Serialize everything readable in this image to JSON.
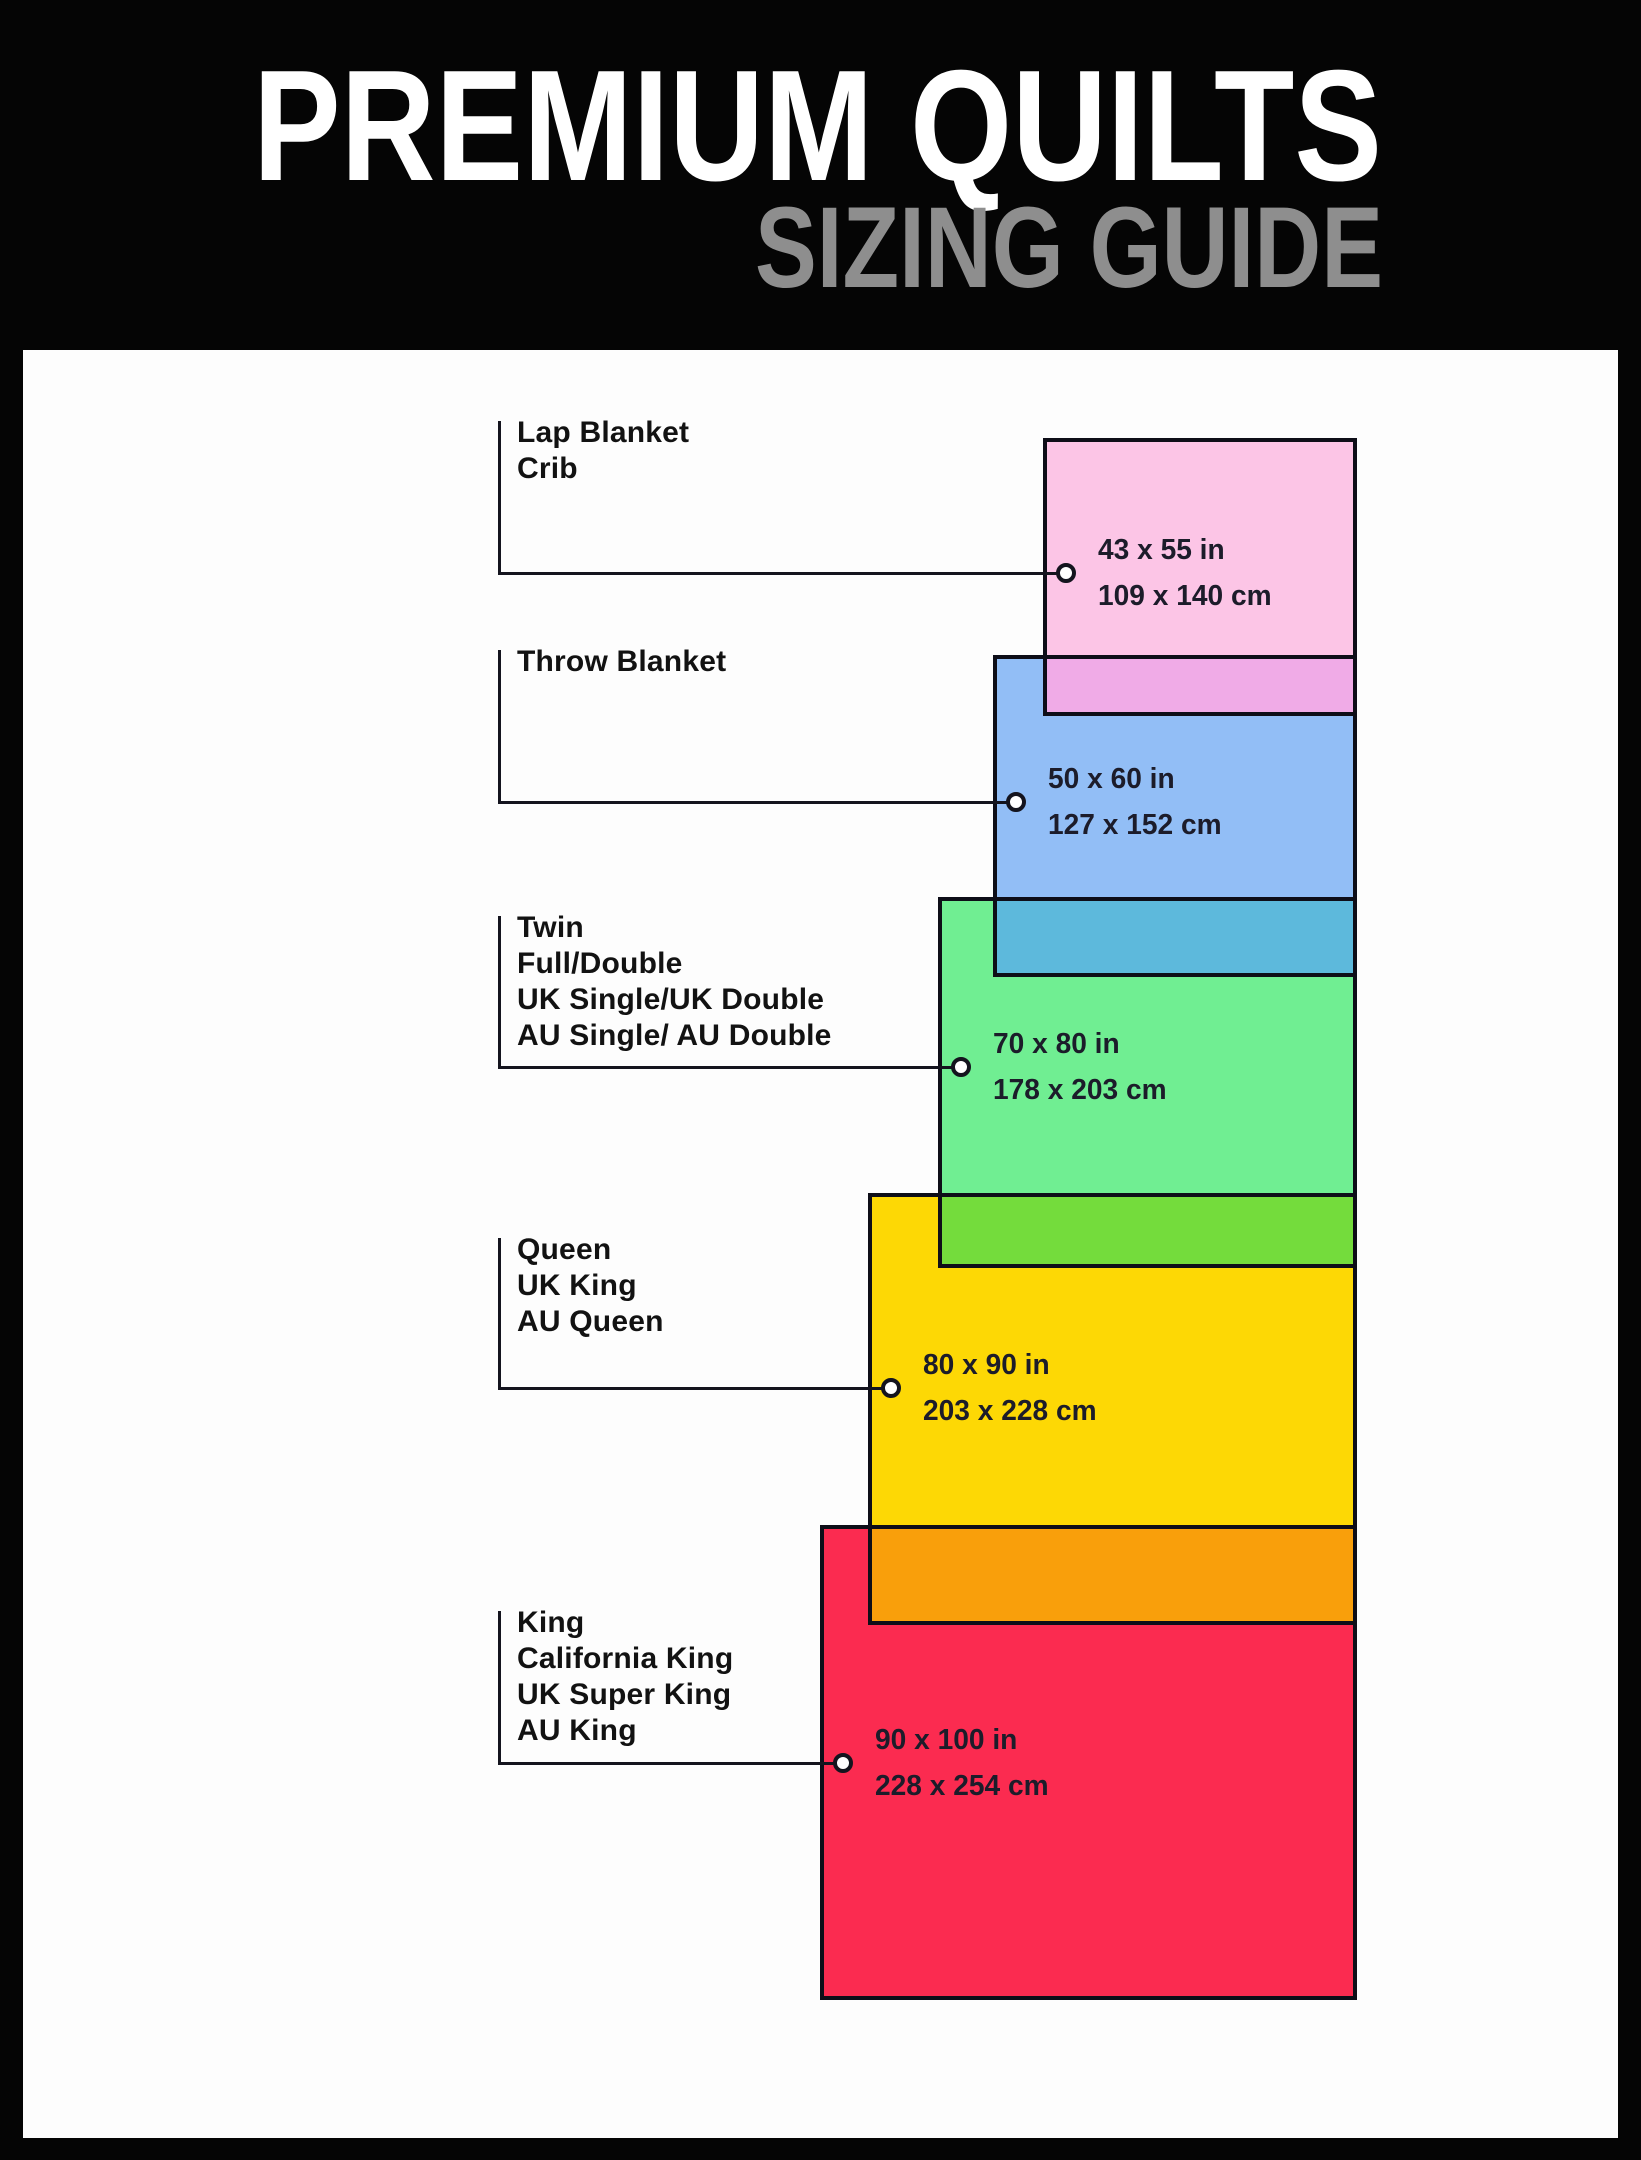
{
  "header": {
    "title": "PREMIUM QUILTS",
    "subtitle": "SIZING GUIDE",
    "title_color": "#ffffff",
    "subtitle_color": "#8e8e8e",
    "background": "#050505"
  },
  "panel": {
    "background": "#fdfdfd",
    "box": {
      "x": 23,
      "y": 350,
      "w": 1595,
      "h": 1788
    }
  },
  "diagram": {
    "stroke_color": "#0e0e18",
    "line_color": "#14141e",
    "label_color": "#121212",
    "dims_color": "#1c1c2a",
    "dot_fill": "#ffffff",
    "bracket_x": 498,
    "label_x": 517,
    "items": [
      {
        "id": "lap-blanket-crib",
        "labels": [
          "Lap Blanket",
          "Crib"
        ],
        "size_in": "43 x 55 in",
        "size_cm": "109 x 140 cm",
        "fill": "#fcc5e6",
        "overlap_fill": "#f0abe7",
        "box": {
          "x": 1043,
          "y": 438,
          "w": 314,
          "h": 278
        },
        "label_top": 421,
        "connector_y": 573
      },
      {
        "id": "throw-blanket",
        "labels": [
          "Throw Blanket"
        ],
        "size_in": "50 x 60 in",
        "size_cm": "127 x 152 cm",
        "fill": "#92bef6",
        "overlap_fill": "#5db9dc",
        "box": {
          "x": 993,
          "y": 655,
          "w": 364,
          "h": 322
        },
        "label_top": 650,
        "connector_y": 802
      },
      {
        "id": "twin-full-double",
        "labels": [
          "Twin",
          "Full/Double",
          "UK Single/UK Double",
          "AU Single/ AU Double"
        ],
        "size_in": "70 x 80 in",
        "size_cm": "178 x 203 cm",
        "fill": "#70ee92",
        "overlap_fill": "#74dc3c",
        "box": {
          "x": 938,
          "y": 897,
          "w": 419,
          "h": 371
        },
        "label_top": 916,
        "connector_y": 1067
      },
      {
        "id": "queen",
        "labels": [
          "Queen",
          "UK King",
          "AU Queen"
        ],
        "size_in": "80 x 90 in",
        "size_cm": "203 x 228 cm",
        "fill": "#fdd805",
        "overlap_fill": "#f99f0b",
        "box": {
          "x": 868,
          "y": 1193,
          "w": 489,
          "h": 432
        },
        "label_top": 1238,
        "connector_y": 1388
      },
      {
        "id": "king",
        "labels": [
          "King",
          "California King",
          "UK Super King",
          "AU King"
        ],
        "size_in": "90 x 100 in",
        "size_cm": "228 x 254 cm",
        "fill": "#fb2b50",
        "overlap_fill": null,
        "box": {
          "x": 820,
          "y": 1525,
          "w": 537,
          "h": 475
        },
        "label_top": 1611,
        "connector_y": 1763
      }
    ]
  }
}
